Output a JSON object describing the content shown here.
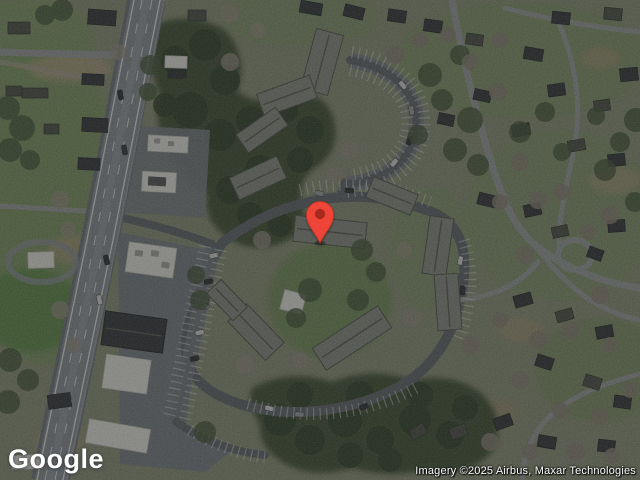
{
  "map": {
    "view_mode": "satellite",
    "pin": {
      "color": "#ef4537",
      "inner_color": "#a82a1e",
      "outline_color": "#c2351f"
    }
  },
  "branding": {
    "logo_text": "Google"
  },
  "attribution": {
    "text": "Imagery ©2025 Airbus, Maxar Technologies"
  },
  "palette": {
    "ground_base": "#8c9377",
    "lawn_green": "#6f9156",
    "forest_green": "#3c5033",
    "highway_asphalt": "#8a9196",
    "parking_asphalt": "#61676c",
    "bare_tree_gray": "#8d8677",
    "roof_white": "#ecece6",
    "roof_dark": "#32363a"
  }
}
